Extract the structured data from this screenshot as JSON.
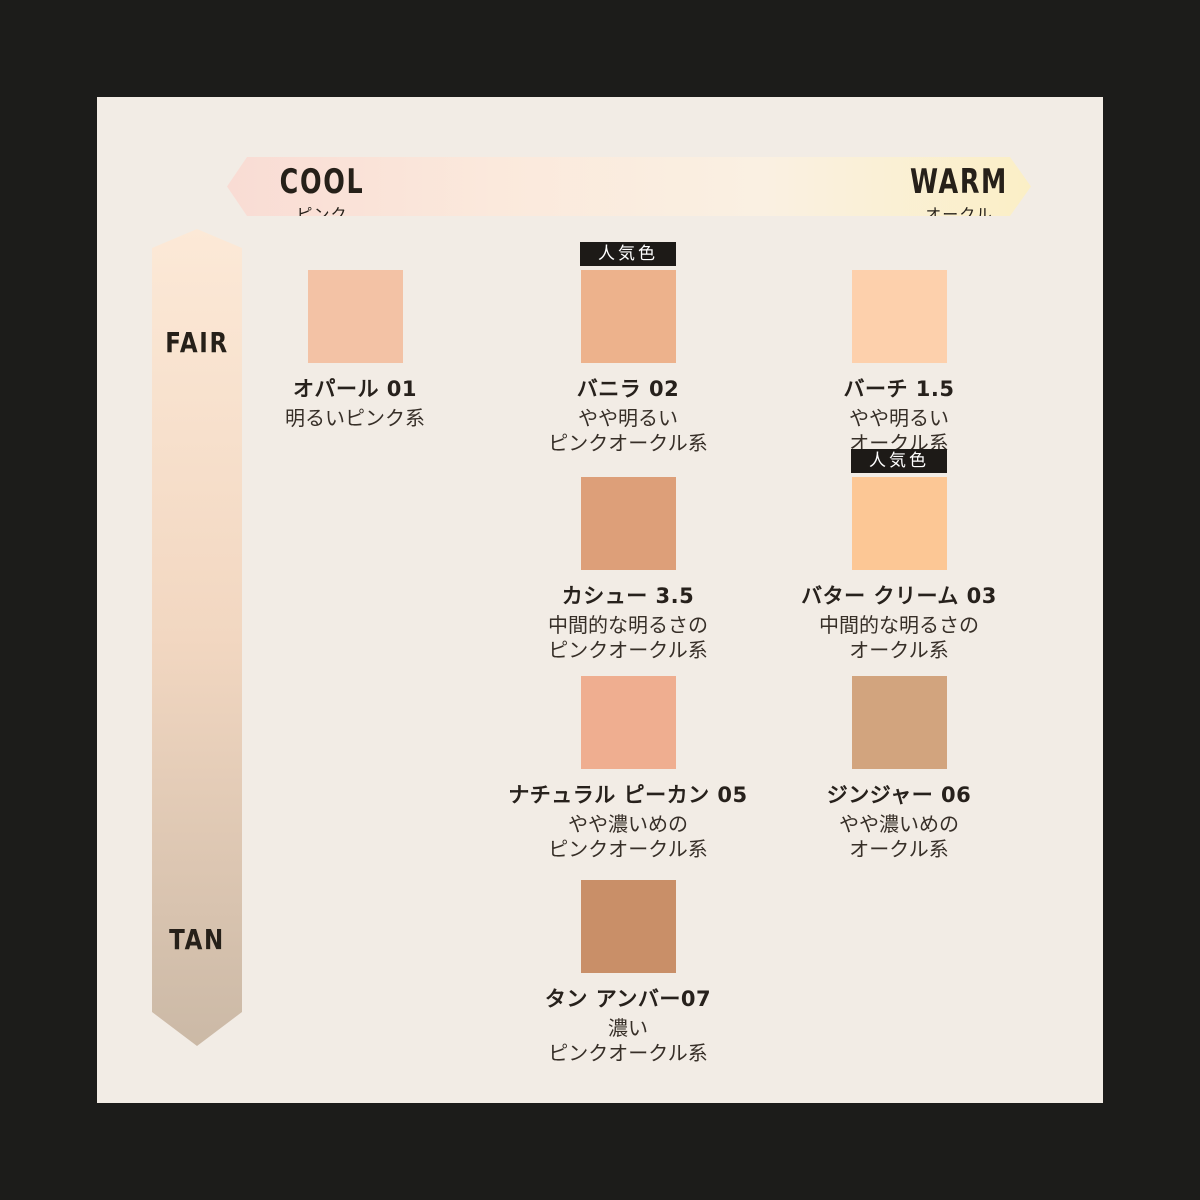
{
  "page": {
    "background_color": "#1c1c1a",
    "panel_color": "#f2ece5"
  },
  "axes": {
    "horizontal": {
      "left_label": "COOL",
      "left_sublabel": "ピンク",
      "right_label": "WARM",
      "right_sublabel": "オークル",
      "gradient": [
        "#f9dcd4",
        "#fbe9dc",
        "#faf0e2",
        "#fbefc6"
      ]
    },
    "vertical": {
      "top_label": "FAIR",
      "bottom_label": "TAN",
      "gradient": [
        "#fce9d7",
        "#f2d7c1",
        "#cbb9a6"
      ]
    }
  },
  "badge_label": "人気色",
  "shades": [
    {
      "name": "オパール 01",
      "desc": [
        "明るいピンク系"
      ],
      "color": "#f3c2a5",
      "row": 0,
      "col": 0,
      "popular": false
    },
    {
      "name": "バニラ 02",
      "desc": [
        "やや明るい",
        "ピンクオークル系"
      ],
      "color": "#edb28c",
      "row": 0,
      "col": 1,
      "popular": true
    },
    {
      "name": "バーチ 1.5",
      "desc": [
        "やや明るい",
        "オークル系"
      ],
      "color": "#fdd0ac",
      "row": 0,
      "col": 2,
      "popular": false
    },
    {
      "name": "カシュー 3.5",
      "desc": [
        "中間的な明るさの",
        "ピンクオークル系"
      ],
      "color": "#dd9f79",
      "row": 1,
      "col": 1,
      "popular": false
    },
    {
      "name": "バター クリーム 03",
      "desc": [
        "中間的な明るさの",
        "オークル系"
      ],
      "color": "#fcc795",
      "row": 1,
      "col": 2,
      "popular": true
    },
    {
      "name": "ナチュラル ピーカン 05",
      "desc": [
        "やや濃いめの",
        "ピンクオークル系"
      ],
      "color": "#efae90",
      "row": 2,
      "col": 1,
      "popular": false
    },
    {
      "name": "ジンジャー 06",
      "desc": [
        "やや濃いめの",
        "オークル系"
      ],
      "color": "#d2a47e",
      "row": 2,
      "col": 2,
      "popular": false
    },
    {
      "name": "タン アンバー07",
      "desc": [
        "濃い",
        "ピンクオークル系"
      ],
      "color": "#c98f68",
      "row": 3,
      "col": 1,
      "popular": false
    }
  ]
}
